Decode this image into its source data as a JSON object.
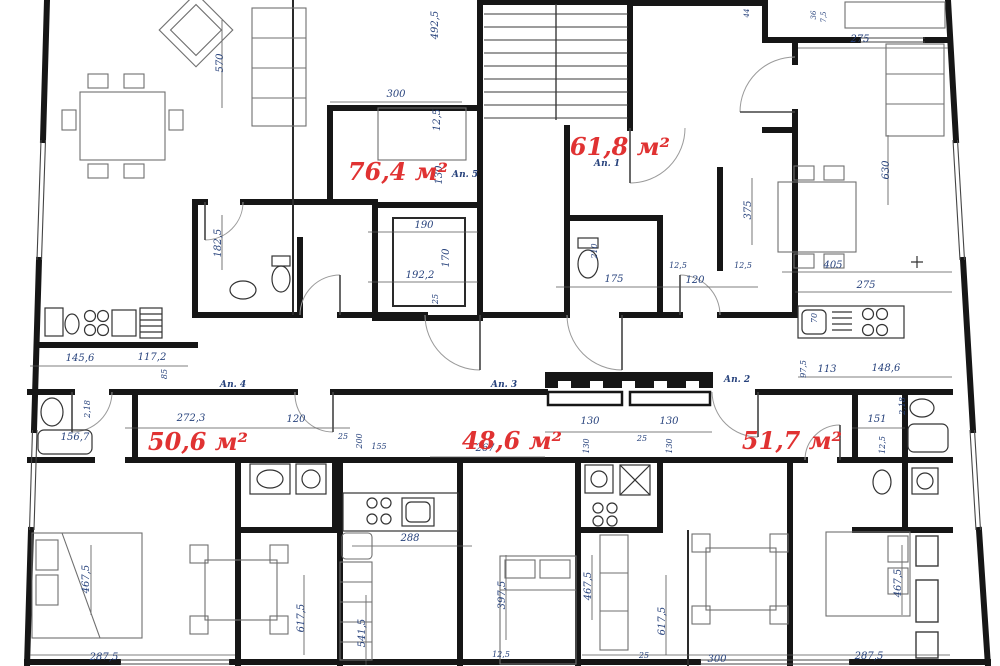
{
  "drawing": {
    "type": "architectural-floor-plan",
    "language": "ru",
    "area_unit": "м²",
    "area_labels": [
      {
        "text": "76,4 м²",
        "x": 398,
        "y": 180
      },
      {
        "text": "61,8 м²",
        "x": 620,
        "y": 155
      },
      {
        "text": "50,6 м²",
        "x": 198,
        "y": 450
      },
      {
        "text": "48,6 м²",
        "x": 512,
        "y": 449
      },
      {
        "text": "51,7 м²",
        "x": 792,
        "y": 449
      }
    ],
    "apartment_labels": [
      {
        "text": "Ап. 5",
        "x": 465,
        "y": 177
      },
      {
        "text": "Ап. 1",
        "x": 607,
        "y": 166
      },
      {
        "text": "Ап. 4",
        "x": 233,
        "y": 387
      },
      {
        "text": "Ап. 3",
        "x": 504,
        "y": 387
      },
      {
        "text": "Ап. 2",
        "x": 737,
        "y": 382
      }
    ],
    "dimensions": [
      {
        "text": "570",
        "x": 223,
        "y": 63,
        "r": -90
      },
      {
        "text": "492,5",
        "x": 438,
        "y": 25,
        "r": -90
      },
      {
        "text": "300",
        "x": 396,
        "y": 97,
        "r": 0
      },
      {
        "text": "12,5",
        "x": 440,
        "y": 120,
        "r": -90
      },
      {
        "text": "130",
        "x": 442,
        "y": 175,
        "r": -90
      },
      {
        "text": "44",
        "x": 749,
        "y": 13,
        "r": -90,
        "fs": 7
      },
      {
        "text": "36",
        "x": 816,
        "y": 15,
        "r": -90,
        "fs": 7
      },
      {
        "text": "7,5",
        "x": 826,
        "y": 17,
        "r": -90,
        "fs": 7
      },
      {
        "text": "275",
        "x": 860,
        "y": 42,
        "r": 0
      },
      {
        "text": "630",
        "x": 889,
        "y": 170,
        "r": -90
      },
      {
        "text": "375",
        "x": 751,
        "y": 210,
        "r": -90
      },
      {
        "text": "405",
        "x": 833,
        "y": 268,
        "r": 0
      },
      {
        "text": "275",
        "x": 866,
        "y": 288,
        "r": 0
      },
      {
        "text": "70",
        "x": 817,
        "y": 318,
        "r": -90,
        "fs": 8
      },
      {
        "text": "182,5",
        "x": 221,
        "y": 243,
        "r": -90
      },
      {
        "text": "190",
        "x": 424,
        "y": 228,
        "r": 0
      },
      {
        "text": "170",
        "x": 449,
        "y": 258,
        "r": -90
      },
      {
        "text": "192,2",
        "x": 420,
        "y": 278,
        "r": 0
      },
      {
        "text": "25",
        "x": 438,
        "y": 299,
        "r": -90,
        "fs": 8
      },
      {
        "text": "210",
        "x": 597,
        "y": 251,
        "r": -90,
        "fs": 8
      },
      {
        "text": "175",
        "x": 614,
        "y": 282,
        "r": 0
      },
      {
        "text": "12,5",
        "x": 678,
        "y": 268,
        "r": 0,
        "fs": 8
      },
      {
        "text": "120",
        "x": 695,
        "y": 283,
        "r": 0
      },
      {
        "text": "12,5",
        "x": 743,
        "y": 268,
        "r": 0,
        "fs": 8
      },
      {
        "text": "145,6",
        "x": 80,
        "y": 361,
        "r": 0
      },
      {
        "text": "117,2",
        "x": 152,
        "y": 360,
        "r": 0
      },
      {
        "text": "85",
        "x": 167,
        "y": 374,
        "r": -90,
        "fs": 8
      },
      {
        "text": "2,18",
        "x": 90,
        "y": 409,
        "r": -90,
        "fs": 8
      },
      {
        "text": "156,7",
        "x": 75,
        "y": 440,
        "r": 0
      },
      {
        "text": "272,3",
        "x": 191,
        "y": 421,
        "r": 0
      },
      {
        "text": "120",
        "x": 296,
        "y": 422,
        "r": 0
      },
      {
        "text": "25",
        "x": 343,
        "y": 439,
        "r": 0,
        "fs": 8
      },
      {
        "text": "200",
        "x": 362,
        "y": 441,
        "r": -90,
        "fs": 8
      },
      {
        "text": "155",
        "x": 379,
        "y": 449,
        "r": 0,
        "fs": 8
      },
      {
        "text": "267",
        "x": 485,
        "y": 451,
        "r": 0
      },
      {
        "text": "130",
        "x": 590,
        "y": 424,
        "r": 0
      },
      {
        "text": "130",
        "x": 589,
        "y": 446,
        "r": -90,
        "fs": 8
      },
      {
        "text": "25",
        "x": 642,
        "y": 441,
        "r": 0,
        "fs": 8
      },
      {
        "text": "130",
        "x": 669,
        "y": 424,
        "r": 0
      },
      {
        "text": "130",
        "x": 672,
        "y": 446,
        "r": -90,
        "fs": 8
      },
      {
        "text": "97,5",
        "x": 806,
        "y": 369,
        "r": -90,
        "fs": 8
      },
      {
        "text": "113",
        "x": 827,
        "y": 372,
        "r": 0
      },
      {
        "text": "148,6",
        "x": 886,
        "y": 371,
        "r": 0
      },
      {
        "text": "2,18",
        "x": 905,
        "y": 406,
        "r": -90,
        "fs": 8
      },
      {
        "text": "151",
        "x": 877,
        "y": 422,
        "r": 0
      },
      {
        "text": "12,5",
        "x": 885,
        "y": 445,
        "r": -90,
        "fs": 8
      },
      {
        "text": "467,5",
        "x": 89,
        "y": 579,
        "r": -90
      },
      {
        "text": "287,5",
        "x": 104,
        "y": 660,
        "r": 0
      },
      {
        "text": "617,5",
        "x": 304,
        "y": 618,
        "r": -90
      },
      {
        "text": "541,5",
        "x": 365,
        "y": 633,
        "r": -90
      },
      {
        "text": "288",
        "x": 410,
        "y": 541,
        "r": 0
      },
      {
        "text": "397,5",
        "x": 505,
        "y": 595,
        "r": -90
      },
      {
        "text": "12,5",
        "x": 501,
        "y": 657,
        "r": 0,
        "fs": 8
      },
      {
        "text": "467,5",
        "x": 591,
        "y": 586,
        "r": -90
      },
      {
        "text": "617,5",
        "x": 665,
        "y": 621,
        "r": -90
      },
      {
        "text": "25",
        "x": 644,
        "y": 658,
        "r": 0,
        "fs": 8
      },
      {
        "text": "300",
        "x": 717,
        "y": 662,
        "r": 0
      },
      {
        "text": "287,5",
        "x": 869,
        "y": 659,
        "r": 0
      },
      {
        "text": "467,5",
        "x": 901,
        "y": 583,
        "r": -90
      }
    ],
    "colors": {
      "wall": "#161616",
      "dimension_text": "#27427c",
      "area_text": "#e03232",
      "furniture": "#6f6f6f"
    }
  }
}
